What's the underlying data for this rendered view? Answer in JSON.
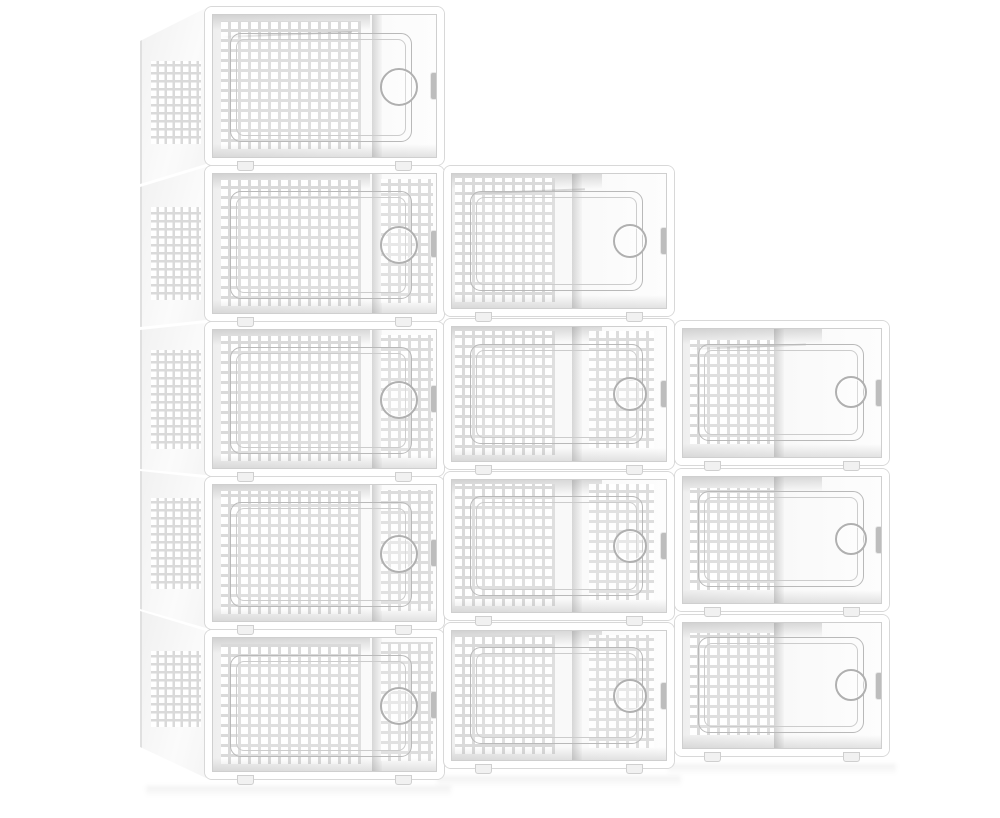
{
  "product": {
    "name": "clear-stackable-shoe-storage-boxes",
    "visible_box_count": 12,
    "arrangement": "three stair-stepped stacks of 5, 4 and 3 boxes",
    "background_color": "#ffffff",
    "palette": {
      "frame_white": "#ffffff",
      "frame_edge_gray": "#d8d8d8",
      "lattice_gray": "#dadada",
      "hole_white": "#ffffff",
      "door_line_gray": "#b9b9b9",
      "latch_gray": "#bdbdbd",
      "shade_gray": "#969696"
    },
    "columns": [
      {
        "name": "left-stack",
        "box_count": 5,
        "x": 206,
        "w": 237,
        "shadow_y": 786,
        "style": {
          "perfA": {
            "l": 4,
            "w": 62,
            "t": 5,
            "b": 6
          },
          "divider": 71,
          "perfB": {
            "l": 75,
            "w": 23,
            "t": 4,
            "b": 8
          },
          "door": {
            "l": 8,
            "r": 11,
            "t": 13,
            "b": 11
          },
          "handle": 34
        },
        "boxes": [
          {
            "y": 8,
            "h": 156,
            "perfB": false,
            "side": {
              "sTop": 33,
              "sBot": 20
            }
          },
          {
            "y": 167,
            "h": 153,
            "perfB": true,
            "side": {
              "sTop": 20,
              "sBot": 7
            }
          },
          {
            "y": 323,
            "h": 152,
            "perfB": true,
            "side": {
              "sTop": 7,
              "sBot": -6
            }
          },
          {
            "y": 478,
            "h": 150,
            "perfB": true,
            "side": {
              "sTop": -7,
              "sBot": -19
            }
          },
          {
            "y": 631,
            "h": 147,
            "perfB": true,
            "side": {
              "sTop": -20,
              "sBot": -31
            }
          }
        ]
      },
      {
        "name": "middle-stack",
        "box_count": 4,
        "x": 445,
        "w": 228,
        "shadow_y": 776,
        "style": {
          "perfA": {
            "l": 2,
            "w": 46,
            "t": 4,
            "b": 5
          },
          "divider": 56,
          "perfB": {
            "l": 64,
            "w": 30,
            "t": 4,
            "b": 10
          },
          "door": {
            "l": 9,
            "r": 11,
            "t": 13,
            "b": 13
          },
          "handle": 30
        },
        "boxes": [
          {
            "y": 167,
            "h": 148,
            "perfB": false
          },
          {
            "y": 320,
            "h": 148,
            "perfB": true
          },
          {
            "y": 473,
            "h": 146,
            "perfB": true
          },
          {
            "y": 624,
            "h": 143,
            "perfB": true
          }
        ]
      },
      {
        "name": "right-stack",
        "box_count": 3,
        "x": 676,
        "w": 212,
        "shadow_y": 764,
        "style": {
          "perfA": {
            "l": 4,
            "w": 42,
            "t": 9,
            "b": 11
          },
          "divider": 46,
          "perfB": null,
          "door": {
            "l": 8,
            "r": 9,
            "t": 12,
            "b": 13
          },
          "handle": 28
        },
        "boxes": [
          {
            "y": 322,
            "h": 142,
            "perfB": false
          },
          {
            "y": 470,
            "h": 140,
            "perfB": false
          },
          {
            "y": 616,
            "h": 139,
            "perfB": false
          }
        ]
      }
    ]
  }
}
